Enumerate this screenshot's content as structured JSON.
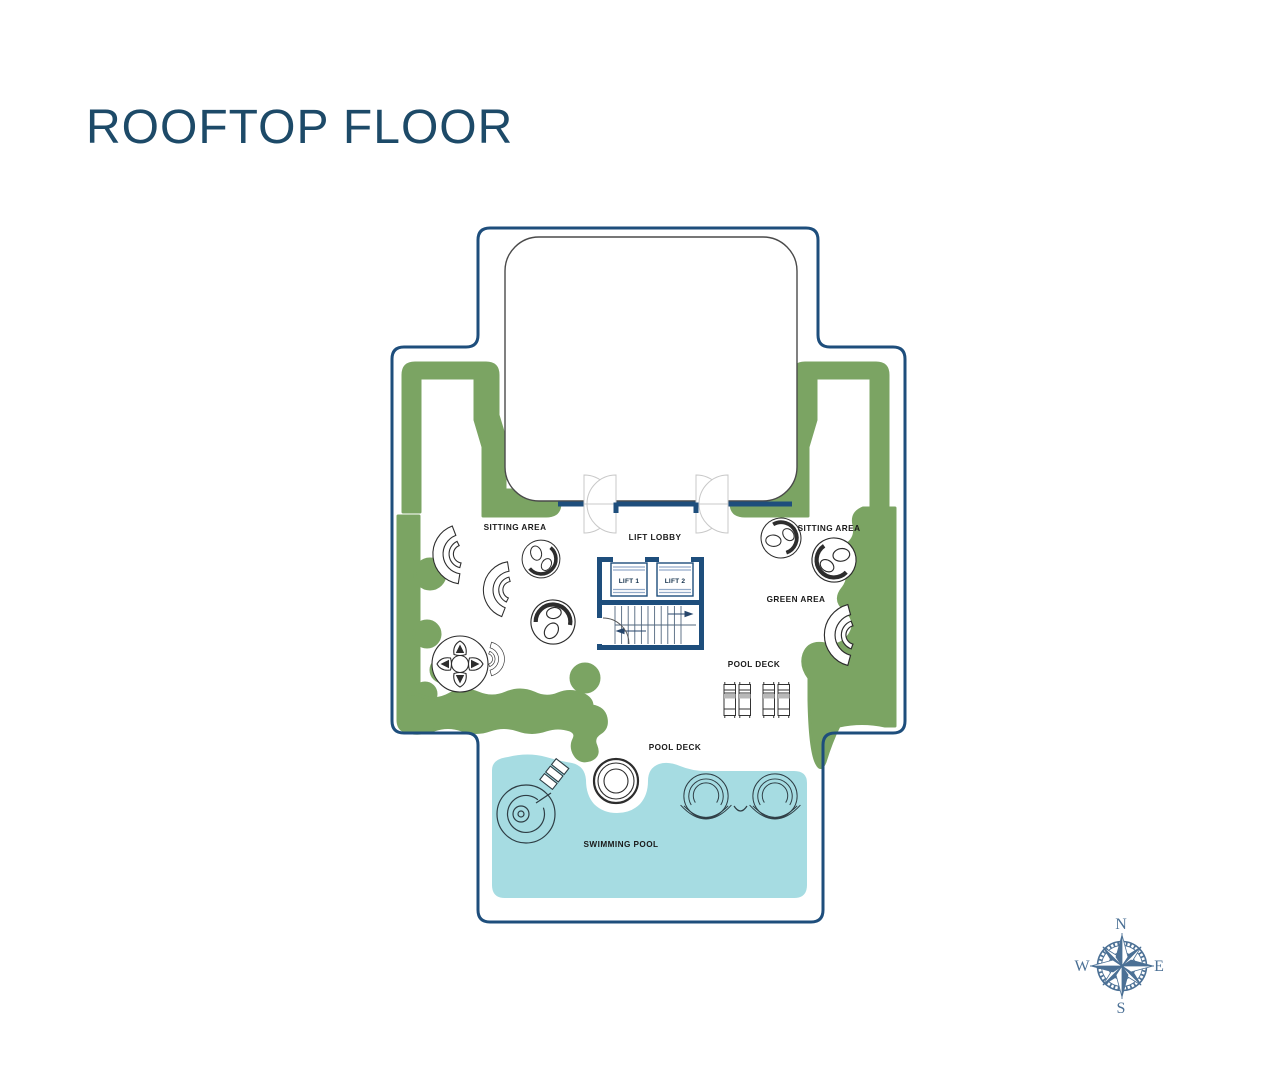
{
  "title": {
    "text": "ROOFTOP FLOOR"
  },
  "plan": {
    "labels": {
      "sitting_area_left": "SITTING AREA",
      "sitting_area_right": "SITTING AREA",
      "lift_lobby": "LIFT LOBBY",
      "lift_1": "LIFT 1",
      "lift_2": "LIFT 2",
      "green_area": "GREEN AREA",
      "pool_deck_upper": "POOL DECK",
      "pool_deck_lower": "POOL DECK",
      "swimming_pool": "SWIMMING POOL"
    },
    "colors": {
      "outline_navy": "#1e4e7c",
      "green": "#7ba463",
      "pool_water": "#a6dce2",
      "title_text": "#1d4a68",
      "compass_blue": "#4b7095"
    }
  },
  "compass": {
    "n": "N",
    "s": "S",
    "e": "E",
    "w": "W"
  }
}
